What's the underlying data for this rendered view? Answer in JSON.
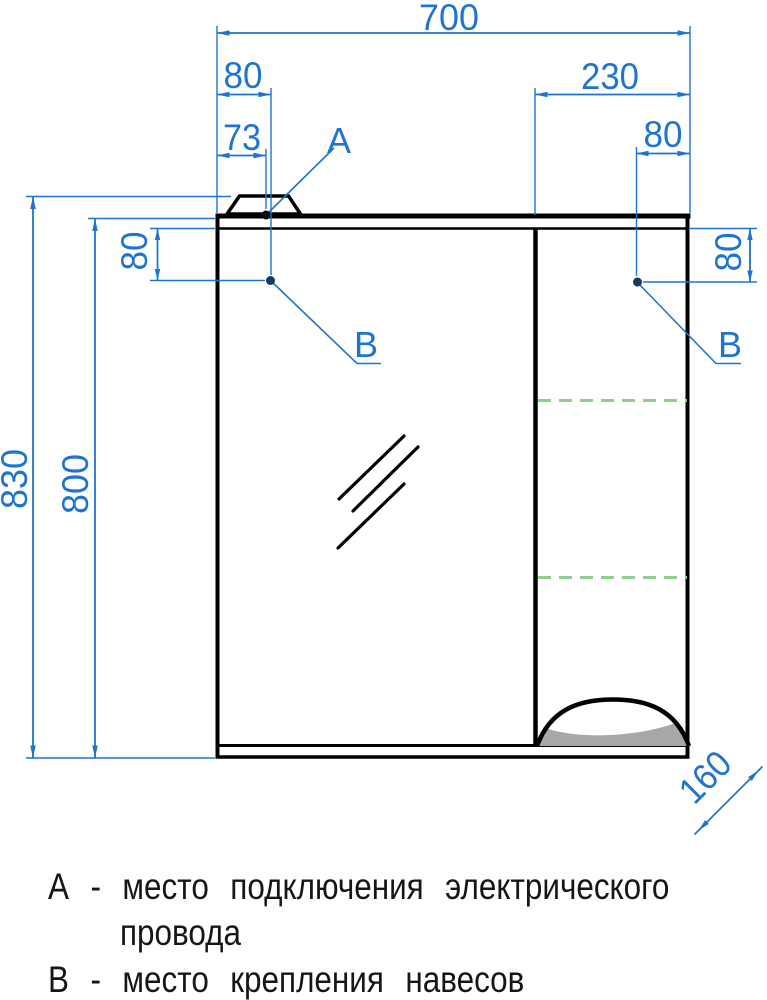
{
  "drawing": {
    "dims": {
      "total_width": "700",
      "b_left_offset_x": "80",
      "a_offset_x": "73",
      "right_section_width": "230",
      "b_right_offset_x": "80",
      "total_height": "830",
      "body_height": "800",
      "b_left_offset_y": "80",
      "b_right_offset_y": "80",
      "depth": "160"
    },
    "point_labels": {
      "a": "A",
      "b_left": "B",
      "b_right": "B"
    }
  },
  "legend": {
    "lines": [
      {
        "text": "А - место подключения электрического"
      },
      {
        "text": "провода"
      },
      {
        "text": "В - место крепления навесов"
      }
    ]
  },
  "colors": {
    "dimension_blue": "#1e74d0",
    "shelf_green": "#8fce8c",
    "line_black": "#000000",
    "fill_gray": "#a8a8a8"
  }
}
